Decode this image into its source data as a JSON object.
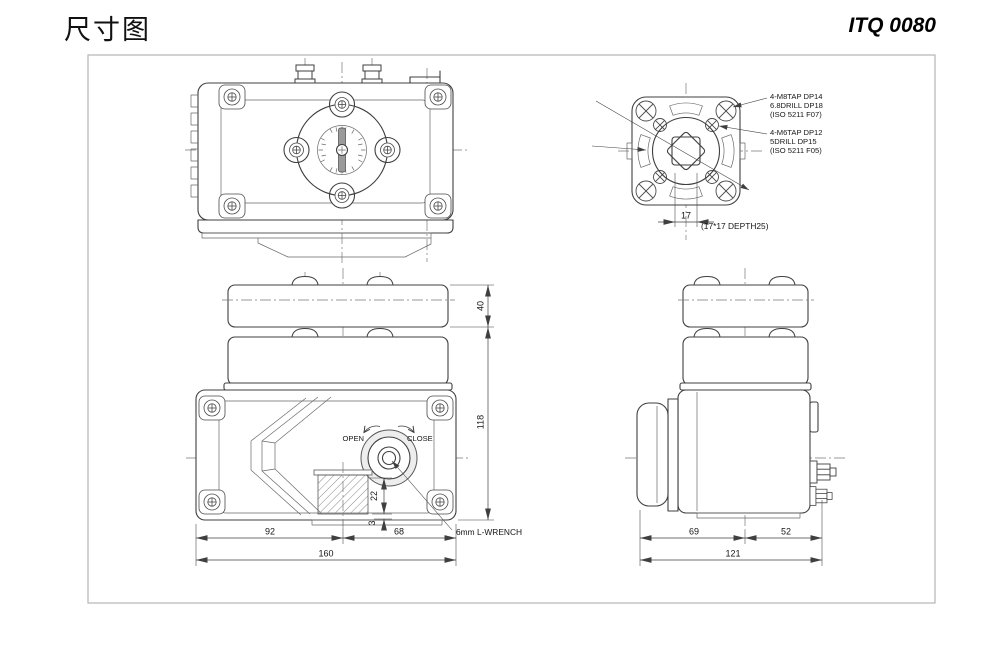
{
  "page": {
    "title_cn": "尺寸图",
    "model": "ITQ 0080"
  },
  "colors": {
    "line": "#3f3f3f",
    "frame_border": "#b5b5b5",
    "text": "#161616",
    "light_fill": "#ededed",
    "hatch": "#8a8a8a"
  },
  "flange_view": {
    "callout_outer": [
      "4-M8TAP DP14",
      "6.8DRILL DP18",
      "(ISO 5211 F07)"
    ],
    "callout_inner": [
      "4-M6TAP DP12",
      "5DRILL DP15",
      "(ISO 5211 F05)"
    ],
    "dim_17": "17",
    "socket_note": "(17*17 DEPTH25)"
  },
  "front_view": {
    "label_open": "OPEN",
    "label_close": "CLOSE",
    "wrench_note": "6mm L-WRENCH",
    "dim_40": "40",
    "dim_118": "118",
    "dim_92": "92",
    "dim_68": "68",
    "dim_160": "160",
    "dim_22": "22",
    "dim_3": "3"
  },
  "side_view": {
    "dim_69": "69",
    "dim_52": "52",
    "dim_121": "121"
  }
}
